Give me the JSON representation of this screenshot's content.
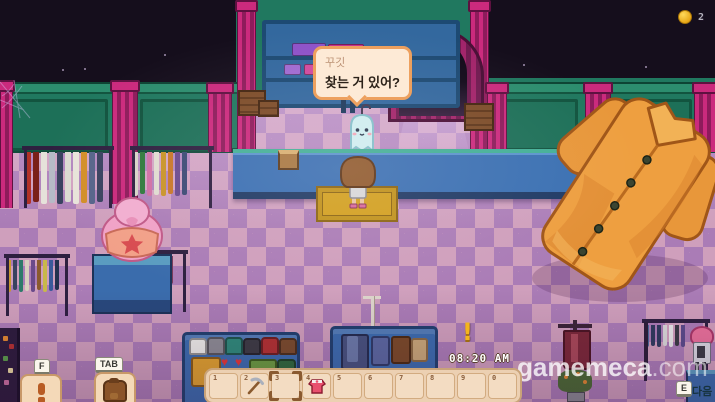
{
  "hud": {
    "coins": "2",
    "clock": "08:20 AM",
    "alert": "!"
  },
  "dialogue": {
    "speaker": "꾸깃",
    "text": "찾는 거 있어?"
  },
  "hotbar": {
    "slots": [
      {
        "num": "1",
        "item": ""
      },
      {
        "num": "2",
        "item": "pickaxe"
      },
      {
        "num": "3",
        "item": "",
        "selected": true
      },
      {
        "num": "4",
        "item": "pink-shirt"
      },
      {
        "num": "5",
        "item": ""
      },
      {
        "num": "6",
        "item": ""
      },
      {
        "num": "7",
        "item": ""
      },
      {
        "num": "8",
        "item": ""
      },
      {
        "num": "9",
        "item": ""
      },
      {
        "num": "0",
        "item": ""
      }
    ]
  },
  "controls": {
    "interact": {
      "key": "F",
      "icon": "exclamation-icon"
    },
    "inventory": {
      "key": "TAB",
      "icon": "backpack-icon"
    },
    "dialogue_next": {
      "key": "E",
      "label": "다음"
    }
  },
  "watermark": {
    "name": "gamemeca",
    "tld": ".com"
  },
  "scene": {
    "npc": "ghost-shopkeeper",
    "location": "clothing-shop"
  },
  "colors": {
    "wall_green": "#20785f",
    "pillar_pink": "#cb2a7d",
    "floor_pink": "#cf9fbc",
    "floor_purple": "#aa7cb6",
    "counter_blue": "#3a70b2",
    "counter_teal": "#43b096",
    "bubble_bg": "#fdead6",
    "bubble_border": "#eda05e",
    "hotbar_bg": "#ecd0b2",
    "slot_bg": "#f3dcc2",
    "coin_gold": "#f0b429",
    "giant_shirt_orange": "#ee9f40",
    "ghost_cyan": "#cfeef0",
    "night_sky": "#150e1c"
  }
}
